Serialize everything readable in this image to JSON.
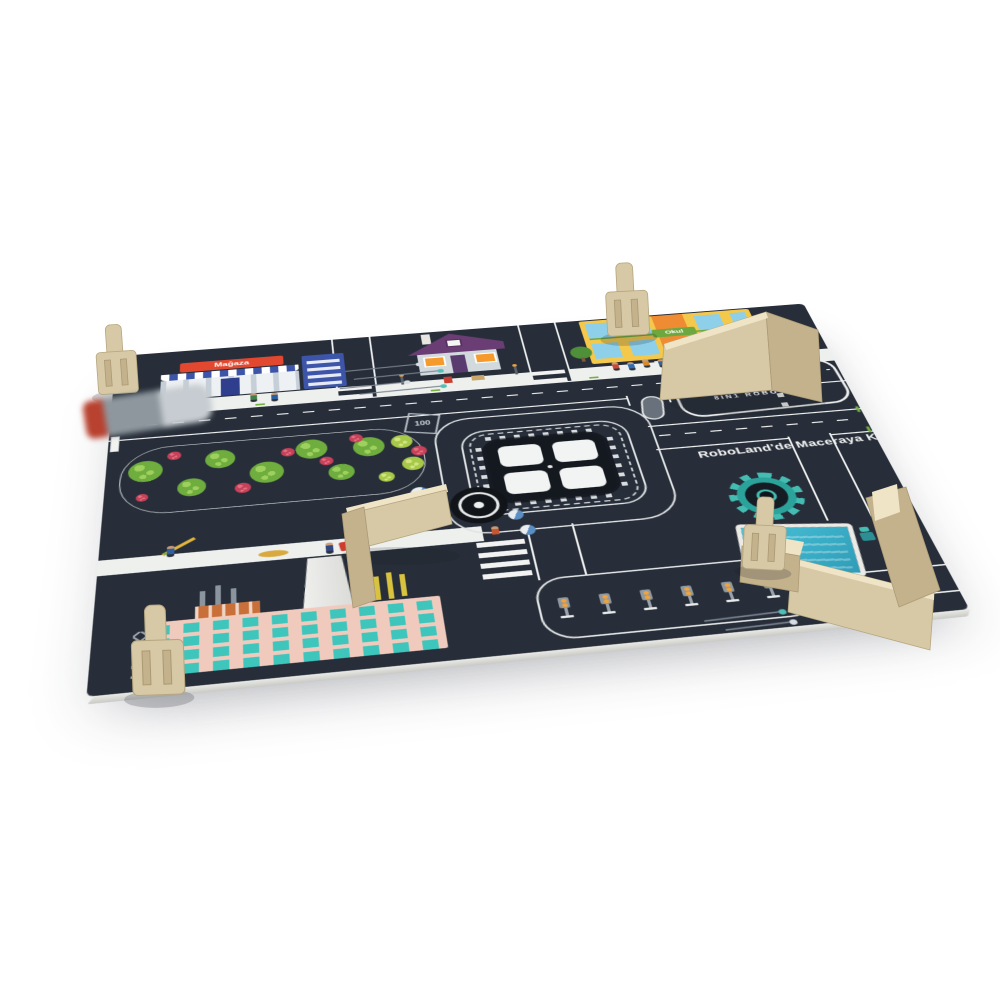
{
  "scene": {
    "type": "3d-product-render",
    "subject": "REX8 8in1 robot kit city playmat (RoboLand) with plywood obstacle walls and wooden clips on a white background"
  },
  "colors": {
    "page-bg": "#ffffff",
    "mat": "#272e39",
    "mat-dark": "#14181f",
    "line": "#eef0ef",
    "accent-orange": "#f1a43c",
    "teal": "#45bcb2",
    "wood": "#d8c9a6",
    "wood-side": "#c3b28c",
    "wood-edge": "#efe4c6",
    "sign-red": "#e2472f",
    "school-yellow": "#f4c84a",
    "school-green": "#6da83f",
    "window-blue": "#8ed0ea",
    "factory-pink": "#f0cbbd",
    "factory-teal": "#3ec6bd",
    "park-green": "#74b13f",
    "park-lime": "#a7c94a",
    "bush-red": "#c8415b",
    "royal-blue": "#3d55a8"
  },
  "logo": {
    "prefix": "RE",
    "accent": "X8",
    "subtitle": "8IN1 ROBOT KIT"
  },
  "slogan": {
    "text": "RoboLand'de Maceraya Kat"
  },
  "labels": {
    "store_sign": "Mağaza",
    "school_sign": "Okul",
    "speed_marker": "100"
  },
  "chip": {
    "windows": 4
  },
  "traffic_zone": {
    "count": 6
  },
  "park": {
    "trees": [
      {
        "x": 24,
        "y": 38,
        "r": 17,
        "t": "g"
      },
      {
        "x": 70,
        "y": 70,
        "r": 14,
        "t": "g"
      },
      {
        "x": 98,
        "y": 28,
        "r": 15,
        "t": "g"
      },
      {
        "x": 144,
        "y": 56,
        "r": 17,
        "t": "g"
      },
      {
        "x": 190,
        "y": 24,
        "r": 16,
        "t": "g"
      },
      {
        "x": 218,
        "y": 66,
        "r": 13,
        "t": "g"
      },
      {
        "x": 248,
        "y": 28,
        "r": 16,
        "t": "g"
      },
      {
        "x": 282,
        "y": 24,
        "r": 11,
        "t": "l"
      },
      {
        "x": 290,
        "y": 62,
        "r": 11,
        "t": "l"
      },
      {
        "x": 262,
        "y": 80,
        "r": 8,
        "t": "l"
      },
      {
        "x": 52,
        "y": 16,
        "r": 7,
        "t": "r"
      },
      {
        "x": 120,
        "y": 78,
        "r": 8,
        "t": "r"
      },
      {
        "x": 166,
        "y": 26,
        "r": 7,
        "t": "r"
      },
      {
        "x": 204,
        "y": 46,
        "r": 7,
        "t": "r"
      },
      {
        "x": 236,
        "y": 12,
        "r": 7,
        "t": "r"
      },
      {
        "x": 298,
        "y": 42,
        "r": 8,
        "t": "r"
      },
      {
        "x": 22,
        "y": 80,
        "r": 6,
        "t": "r"
      }
    ]
  },
  "people": [
    {
      "x": 148,
      "y": 108,
      "c": "#3f7f4a"
    },
    {
      "x": 170,
      "y": 110,
      "c": "#2a5f9e"
    },
    {
      "x": 540,
      "y": 104,
      "c": "#c94a38"
    },
    {
      "x": 557,
      "y": 106,
      "c": "#2e6db4"
    },
    {
      "x": 574,
      "y": 103,
      "c": "#d58a2c"
    },
    {
      "x": 591,
      "y": 105,
      "c": "#38618f"
    },
    {
      "x": 214,
      "y": 364,
      "c": "#32477f"
    },
    {
      "x": 248,
      "y": 364,
      "c": "#32477f"
    },
    {
      "x": 66,
      "y": 348,
      "c": "#2e5f9f"
    },
    {
      "x": 608,
      "y": 452,
      "c": "#f0b23a"
    },
    {
      "x": 372,
      "y": 362,
      "c": "#c8552f"
    }
  ],
  "decorations": {
    "traces": [
      {
        "x": 248,
        "y": 62,
        "w": 80,
        "d": "#d7dde2"
      },
      {
        "x": 256,
        "y": 78,
        "w": 94,
        "d": "#4fc0b6"
      },
      {
        "x": 240,
        "y": 94,
        "w": 72,
        "d": "#d7dde2"
      },
      {
        "x": 260,
        "y": 107,
        "w": 90,
        "d": "#4fc0b6"
      },
      {
        "x": 540,
        "y": 500,
        "w": 72,
        "d": "#4fc0b6"
      },
      {
        "x": 556,
        "y": 514,
        "w": 62,
        "d": "#d7dde2"
      }
    ],
    "dashes": [
      {
        "x": 150,
        "y": 112,
        "r": 0
      },
      {
        "x": 336,
        "y": 112,
        "r": 0
      },
      {
        "x": 508,
        "y": 112,
        "r": 0
      },
      {
        "x": 648,
        "y": 112,
        "r": 0
      },
      {
        "x": 60,
        "y": 341,
        "r": 0
      },
      {
        "x": 262,
        "y": 341,
        "r": 0
      },
      {
        "x": 772,
        "y": 208,
        "r": 90
      },
      {
        "x": 772,
        "y": 244,
        "r": 90
      }
    ],
    "pies": [
      {
        "x": 298,
        "y": 276,
        "s": 18
      },
      {
        "x": 306,
        "y": 300,
        "s": 18
      },
      {
        "x": 388,
        "y": 324,
        "s": 15
      },
      {
        "x": 396,
        "y": 348,
        "s": 15
      }
    ]
  },
  "wood": {
    "clips": [
      {
        "name": "wooden-clip-top-left",
        "x": 94,
        "y": 326,
        "r": -4,
        "s": 1
      },
      {
        "name": "wooden-clip-school",
        "x": 604,
        "y": 264,
        "r": -3,
        "s": 1.05
      },
      {
        "name": "wooden-clip-factory",
        "x": 130,
        "y": 606,
        "r": -2,
        "s": 1.3
      },
      {
        "name": "wooden-clip-workshop",
        "x": 746,
        "y": 496,
        "r": 3,
        "s": 1.05
      }
    ]
  }
}
